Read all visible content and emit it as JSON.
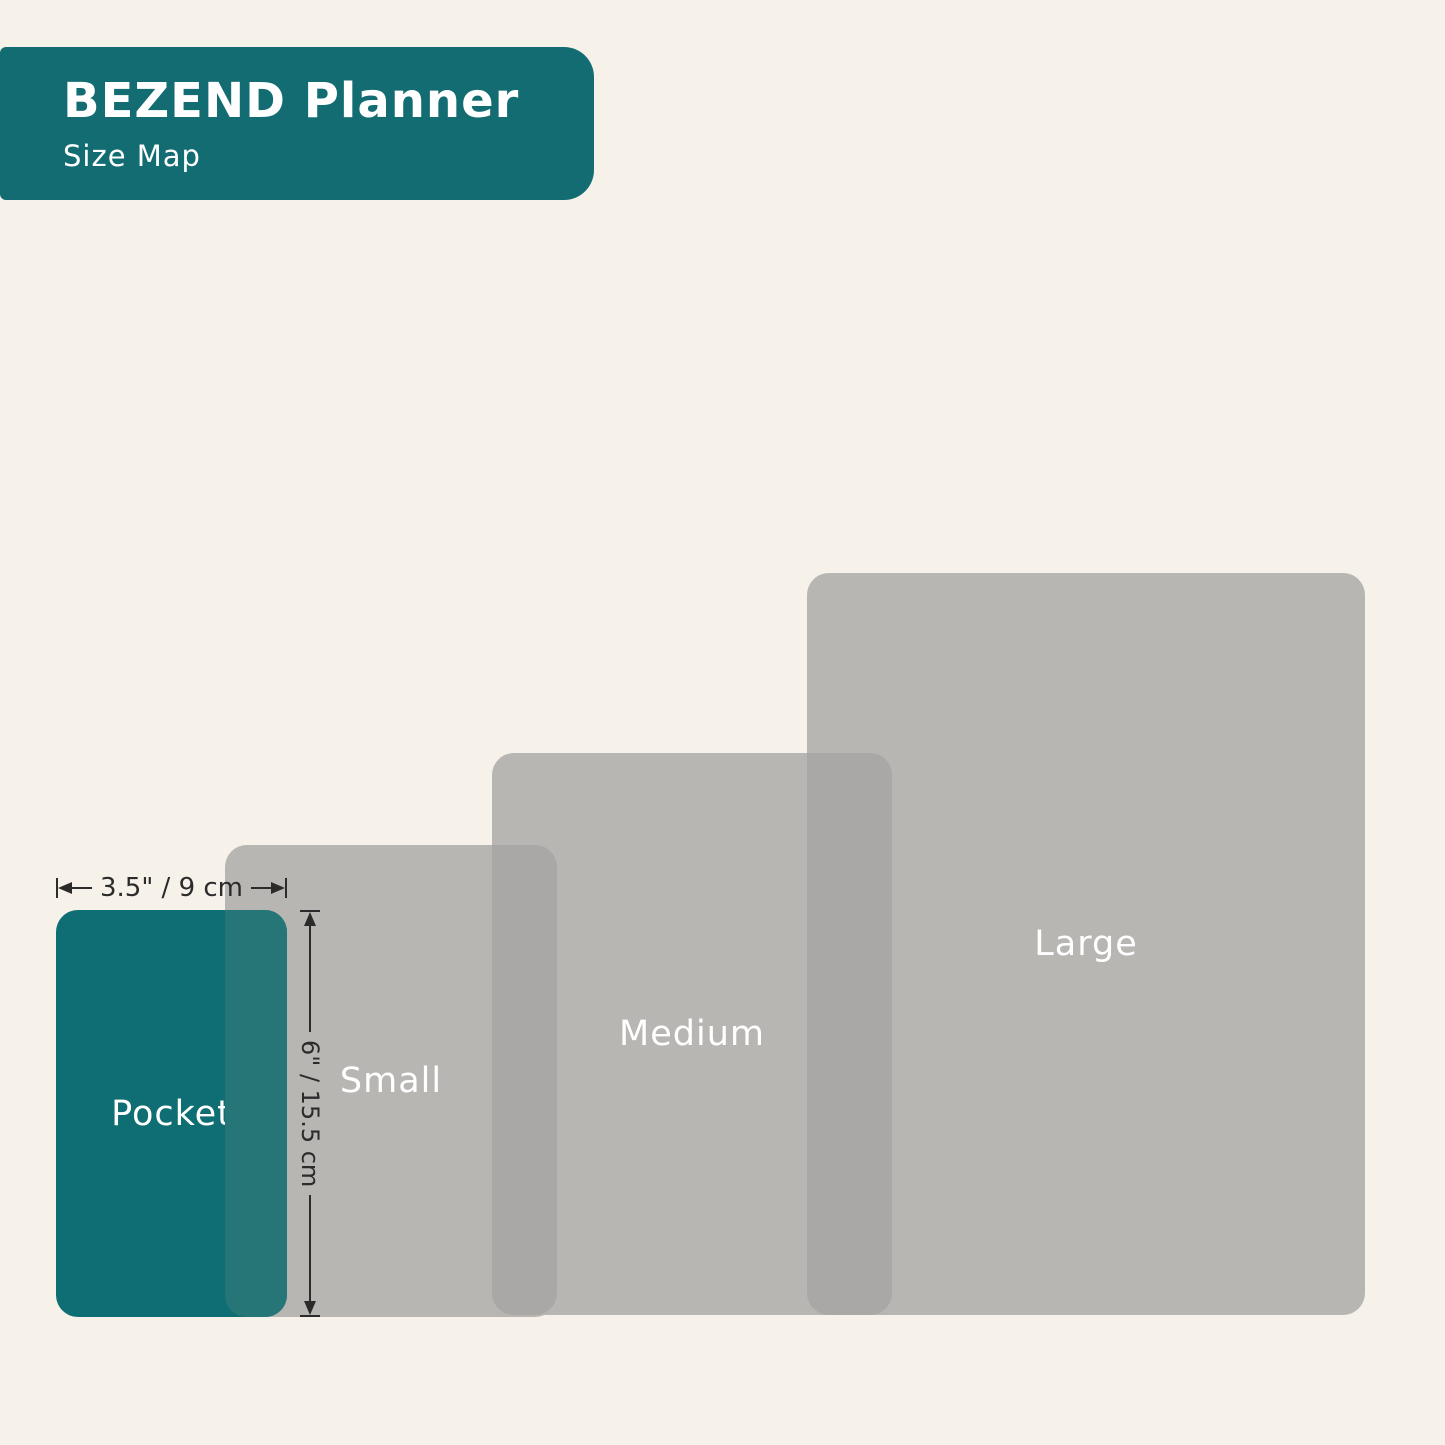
{
  "header": {
    "title": "BEZEND Planner",
    "subtitle": "Size Map",
    "background": "#146c73",
    "text_color": "#ffffff"
  },
  "diagram": {
    "background": "#f6f2e9",
    "sizes": [
      {
        "name": "Large",
        "x": 807,
        "y": 573,
        "w": 558,
        "h": 742,
        "fill": "#b8b6b3",
        "label_color": "#ffffff"
      },
      {
        "name": "Medium",
        "x": 492,
        "y": 753,
        "w": 400,
        "h": 562,
        "fill": "#b8b6b3",
        "label_color": "#ffffff"
      },
      {
        "name": "Small",
        "x": 225,
        "y": 845,
        "w": 332,
        "h": 472,
        "fill": "#b8b6b3",
        "label_color": "#ffffff"
      },
      {
        "name": "Pocket",
        "x": 56,
        "y": 910,
        "w": 231,
        "h": 407,
        "fill": "#0e6e73",
        "label_color": "#ffffff"
      }
    ],
    "overlaps": [
      {
        "name": "large-medium",
        "x": 807,
        "y": 753,
        "w": 85,
        "h": 562,
        "fill": "#a9a8a6"
      },
      {
        "name": "medium-small",
        "x": 492,
        "y": 845,
        "w": 65,
        "h": 470,
        "fill": "#a9a8a6"
      },
      {
        "name": "small-pocket",
        "x": 225,
        "y": 910,
        "w": 62,
        "h": 407,
        "fill": "#267678"
      }
    ],
    "dimensions": {
      "width_label": "3.5\" / 9 cm",
      "height_label": "6\" / 15.5 cm",
      "color": "#2b2b2b"
    }
  }
}
